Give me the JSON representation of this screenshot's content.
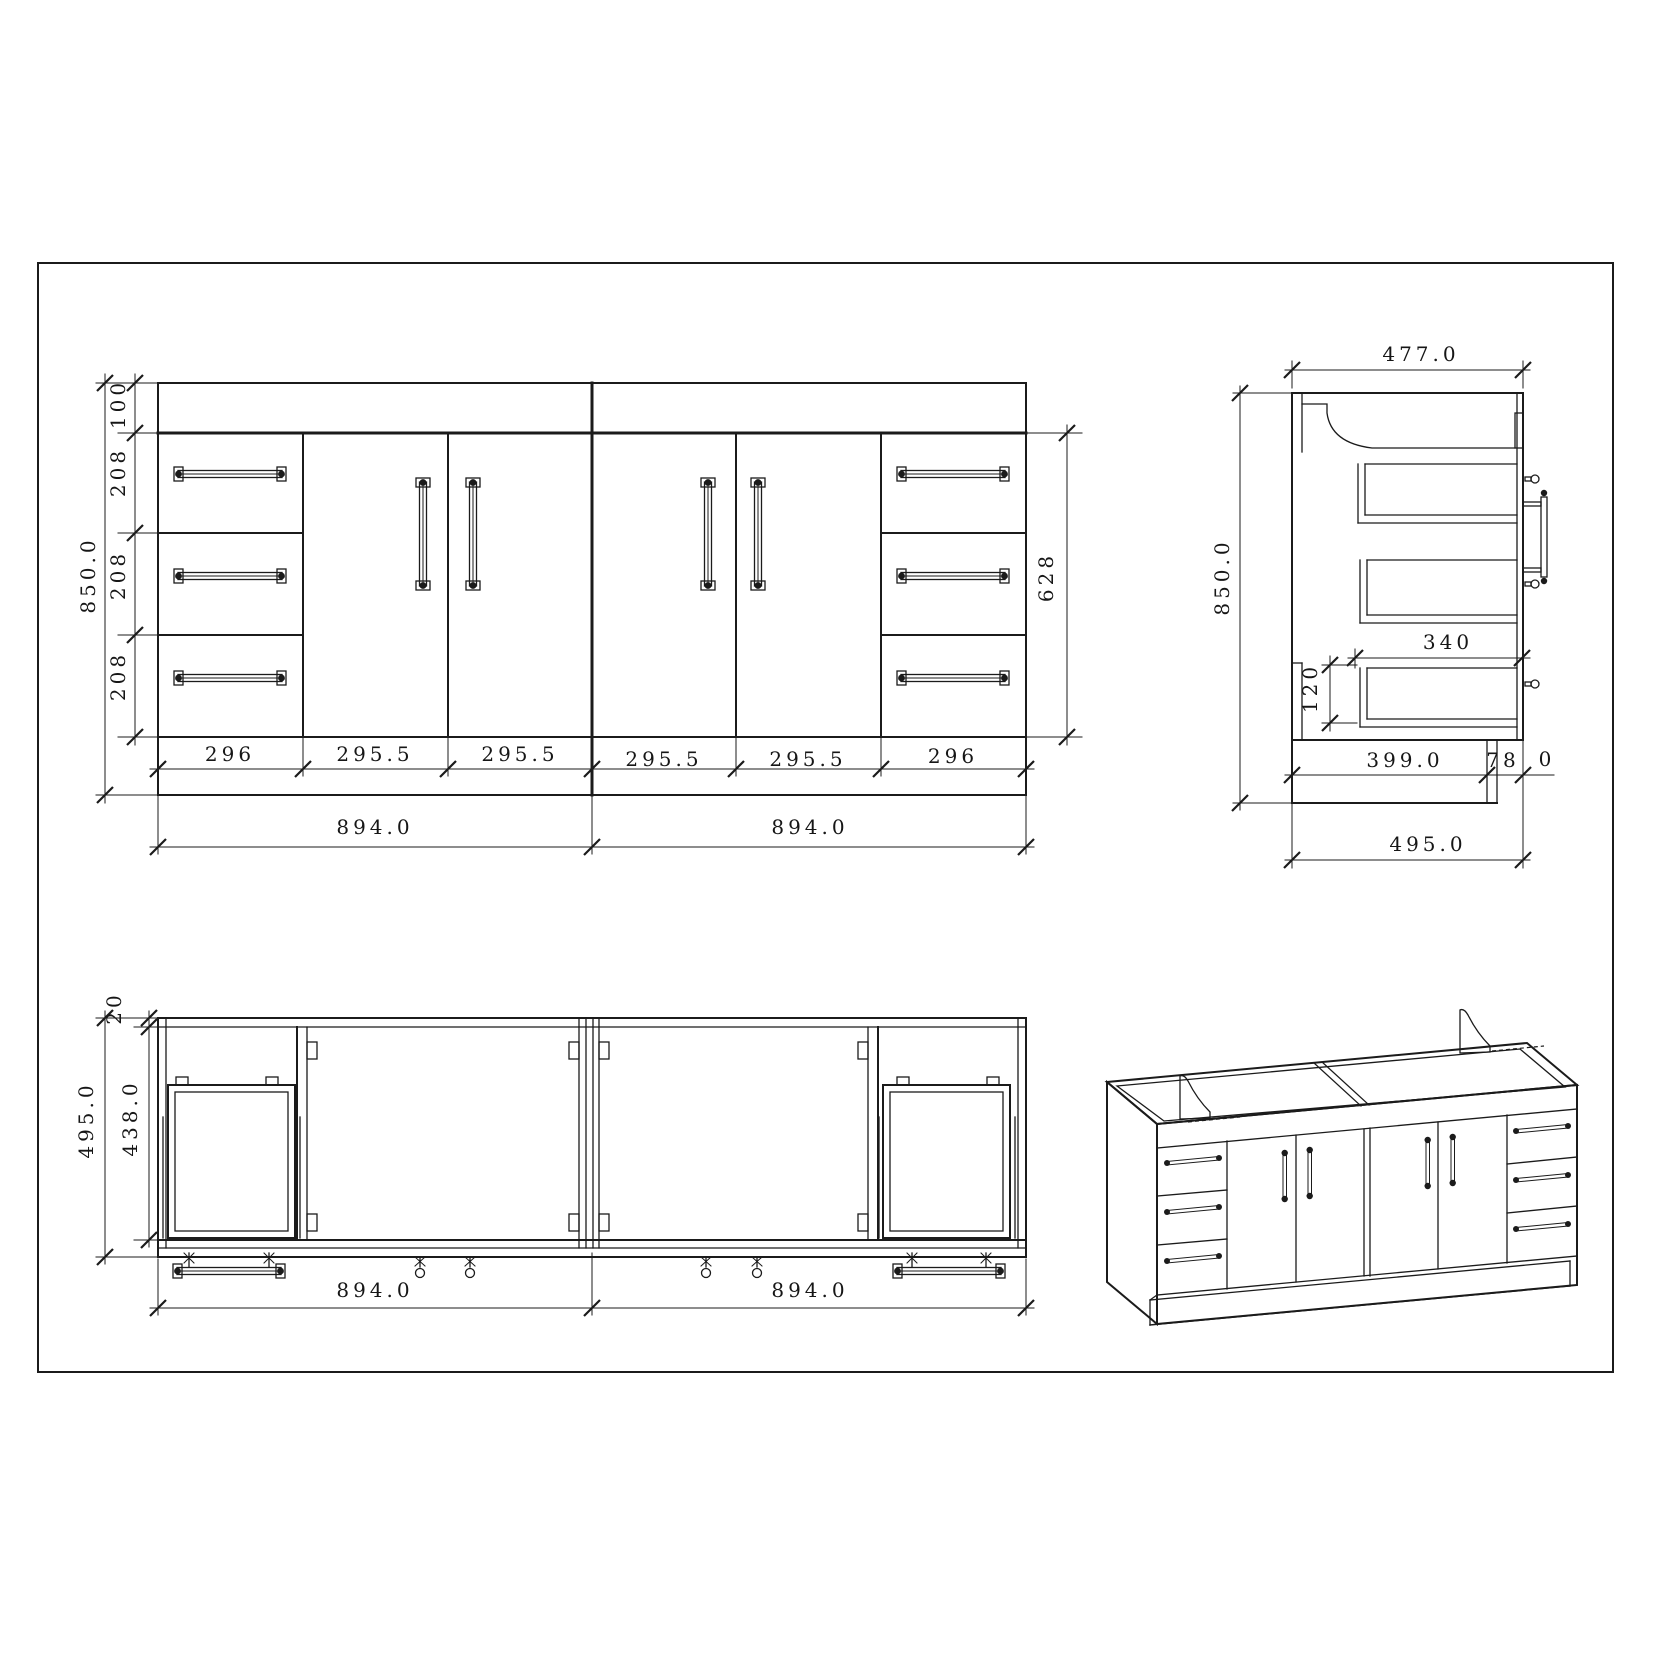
{
  "sheet": {
    "background": "#ffffff",
    "ink": "#1b1b1b"
  },
  "front_view": {
    "dims": {
      "overall_height": "850.0",
      "top_rail": "100",
      "drawer_heights": [
        "208",
        "208",
        "208"
      ],
      "door_stack_height": "628",
      "front_widths": [
        "296",
        "295.5",
        "295.5",
        "295.5",
        "295.5",
        "296"
      ],
      "module_widths": [
        "894.0",
        "894.0"
      ]
    }
  },
  "side_view": {
    "dims": {
      "carcass_depth": "477.0",
      "overall_height": "850.0",
      "drawer_depth": "340",
      "drawer_gap": "120",
      "kick_length": "399.0",
      "kick_setback_int": "78",
      "kick_setback_dec": "0",
      "overall_depth": "495.0"
    }
  },
  "plan_view": {
    "dims": {
      "back_gap": "20",
      "internal_depth": "438.0",
      "overall_depth": "495.0",
      "module_widths": [
        "894.0",
        "894.0"
      ]
    }
  }
}
